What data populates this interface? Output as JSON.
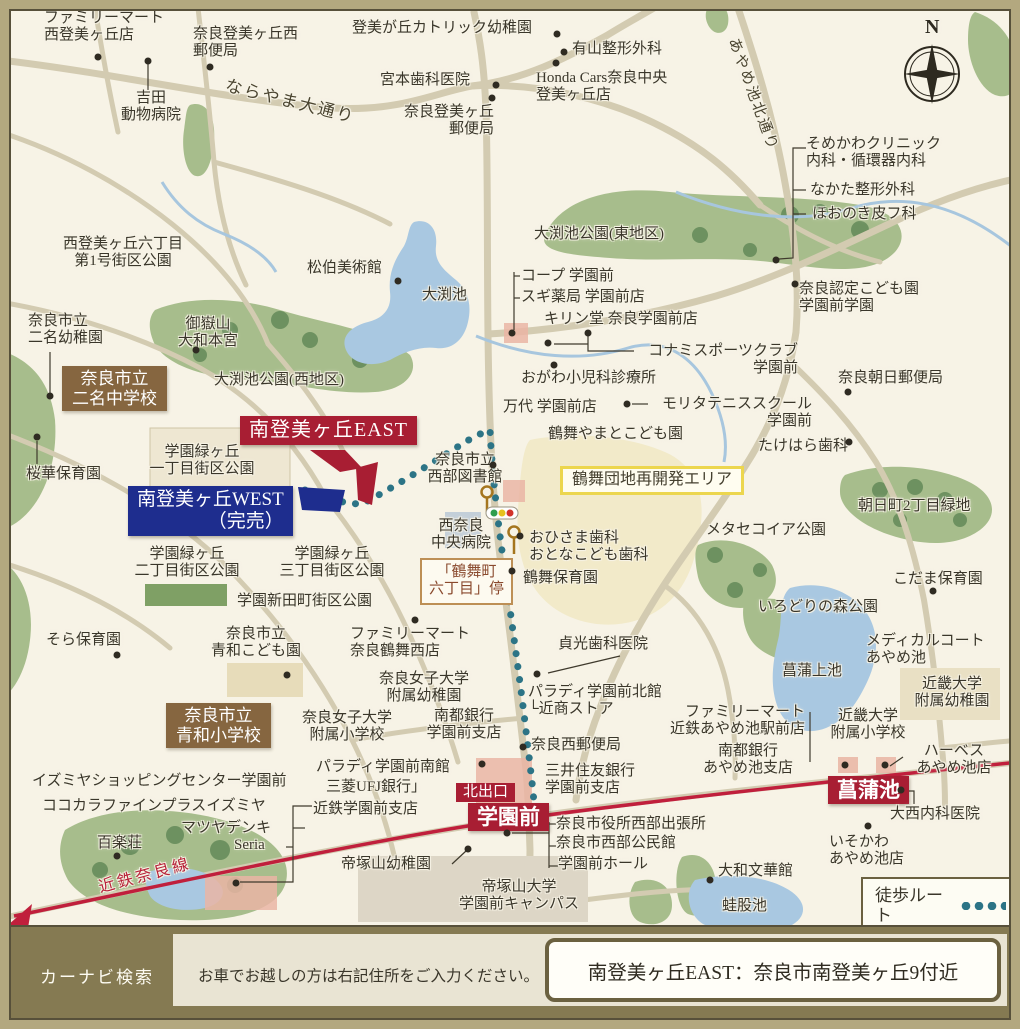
{
  "footer": {
    "navi_label": "カーナビ検索",
    "notice": "お車でお越しの方は右記住所をご入力ください。",
    "address": "南登美ヶ丘EAST：奈良市南登美ヶ丘9付近"
  },
  "colors": {
    "map_bg": "#f7f3e6",
    "road": "#d3cbb1",
    "park": "#a7bd8c",
    "tree": "#6d9160",
    "water": "#a9c8e1",
    "railway": "#c01f3c",
    "walk_route": "#2c7486",
    "badge_red": "#a81e33",
    "badge_blue": "#1e2d8e",
    "badge_brown": "#866640",
    "yellow_box_border": "#ecd64e",
    "frame": "#b3a87f",
    "footer_olive": "#857a52"
  },
  "map": {
    "labels": [
      {
        "name": "label-familymart-nishitomigaoka",
        "text": "ファミリーマート\n西登美ヶ丘店",
        "x": 44,
        "y": 10
      },
      {
        "name": "label-nara-tomigaoka-nishi-post",
        "text": "奈良登美ヶ丘西\n郵便局",
        "x": 193,
        "y": 26
      },
      {
        "name": "label-yoshida-animal-hospital",
        "text": "吉田\n動物病院",
        "x": 110,
        "y": 90,
        "w": 82,
        "align": "center"
      },
      {
        "name": "label-naráyama-odori-road",
        "text": "ならやま大通り",
        "x": 228,
        "y": 76,
        "type": "road",
        "rotate": 14
      },
      {
        "name": "label-tomigaoka-catholic-kindergarten",
        "text": "登美が丘カトリック幼稚園",
        "x": 352,
        "y": 20
      },
      {
        "name": "label-ariyama-seikei",
        "text": "有山整形外科",
        "x": 572,
        "y": 41
      },
      {
        "name": "label-miyamoto-dental",
        "text": "宮本歯科医院",
        "x": 380,
        "y": 72
      },
      {
        "name": "label-honda-cars",
        "text": "Honda Cars奈良中央\n登美ヶ丘店",
        "x": 536,
        "y": 70
      },
      {
        "name": "label-nara-tomigaoka-post",
        "text": "奈良登美ヶ丘\n郵便局",
        "x": 390,
        "y": 104,
        "w": 104,
        "align": "right"
      },
      {
        "name": "label-ayameike-kita-dori-road",
        "text": "あやめ池北通り",
        "x": 740,
        "y": 36,
        "type": "road",
        "rotate": 70,
        "size": 15
      },
      {
        "name": "label-compass-n",
        "text": "N",
        "x": 925,
        "y": 16,
        "type": "compass-n"
      },
      {
        "name": "label-somekawa-clinic",
        "text": "そめかわクリニック\n内科・循環器内科",
        "x": 806,
        "y": 136
      },
      {
        "name": "label-nakata-seikei",
        "text": "なかた整形外科",
        "x": 810,
        "y": 182
      },
      {
        "name": "label-hoonoki-hifuka",
        "text": "ほおのき皮フ科",
        "x": 812,
        "y": 206
      },
      {
        "name": "label-nishitomigaoka-6-park",
        "text": "西登美ヶ丘六丁目\n第1号街区公園",
        "x": 52,
        "y": 236,
        "w": 142,
        "align": "center"
      },
      {
        "name": "label-shohaku-museum",
        "text": "松伯美術館",
        "x": 307,
        "y": 260
      },
      {
        "name": "label-obuchi-pond",
        "text": "大渕池",
        "x": 422,
        "y": 287
      },
      {
        "name": "label-obuchi-park-east",
        "text": "大渕池公園(東地区)",
        "x": 534,
        "y": 226
      },
      {
        "name": "label-coop-gakuenmae",
        "text": "コープ 学園前",
        "x": 521,
        "y": 268
      },
      {
        "name": "label-sugi-pharmacy",
        "text": "スギ薬局 学園前店",
        "x": 521,
        "y": 289
      },
      {
        "name": "label-kirindo",
        "text": "キリン堂 奈良学園前店",
        "x": 544,
        "y": 311
      },
      {
        "name": "label-nara-nintei-kodomoen",
        "text": "奈良認定こども園\n学園前学園",
        "x": 799,
        "y": 281
      },
      {
        "name": "label-nimyo-kindergarten",
        "text": "奈良市立\n二名幼稚園",
        "x": 28,
        "y": 313
      },
      {
        "name": "label-mitakesan-yamato-hongu",
        "text": "御嶽山\n大和本宮",
        "x": 166,
        "y": 316,
        "w": 84,
        "align": "center"
      },
      {
        "name": "badge-nimyo-junior-high",
        "text": "奈良市立\n二名中学校",
        "x": 62,
        "y": 366,
        "type": "badge-brown"
      },
      {
        "name": "label-obuchi-park-west",
        "text": "大渕池公園(西地区)",
        "x": 214,
        "y": 372
      },
      {
        "name": "label-konami-sports",
        "text": "コナミスポーツクラブ\n学園前",
        "x": 634,
        "y": 343,
        "w": 164,
        "align": "right"
      },
      {
        "name": "label-ogawa-pediatrics",
        "text": "おがわ小児科診療所",
        "x": 521,
        "y": 370
      },
      {
        "name": "label-nara-asahi-post",
        "text": "奈良朝日郵便局",
        "x": 838,
        "y": 370
      },
      {
        "name": "label-mandai",
        "text": "万代 学園前店",
        "x": 503,
        "y": 399
      },
      {
        "name": "label-morita-tennis",
        "text": "モリタテニススクール\n学園前",
        "x": 640,
        "y": 396,
        "w": 172,
        "align": "right"
      },
      {
        "name": "badge-minamitomigaoka-east",
        "text": "南登美ヶ丘EAST",
        "x": 240,
        "y": 416,
        "type": "badge-red"
      },
      {
        "name": "label-tsurumai-yamato-kodomoen",
        "text": "鶴舞やまとこども園",
        "x": 548,
        "y": 426
      },
      {
        "name": "label-gakuen-midorigaoka-1-park",
        "text": "学園緑ヶ丘\n一丁目街区公園",
        "x": 140,
        "y": 444,
        "w": 124,
        "align": "center"
      },
      {
        "name": "label-seibu-library",
        "text": "奈良市立\n西部図書館",
        "x": 412,
        "y": 452,
        "w": 106,
        "align": "center"
      },
      {
        "name": "label-takehara-dental",
        "text": "たけはら歯科",
        "x": 758,
        "y": 438
      },
      {
        "name": "box-tsurumai-redevelopment",
        "text": "鶴舞団地再開発エリア",
        "x": 560,
        "y": 466,
        "type": "box-yellow"
      },
      {
        "name": "label-ouka-hoikuen",
        "text": "桜華保育園",
        "x": 26,
        "y": 466
      },
      {
        "name": "badge-minamitomigaoka-west",
        "text": "南登美ヶ丘WEST\n（完売）",
        "x": 128,
        "y": 486,
        "type": "badge-blue",
        "align": "right"
      },
      {
        "name": "label-asahicho-2-ryokuchi",
        "text": "朝日町2丁目緑地",
        "x": 858,
        "y": 498
      },
      {
        "name": "label-nishinara-chuo-hospital",
        "text": "西奈良\n中央病院",
        "x": 422,
        "y": 518,
        "w": 78,
        "align": "center"
      },
      {
        "name": "label-ohisama-dental",
        "text": "おひさま歯科\nおとなこども歯科",
        "x": 529,
        "y": 530
      },
      {
        "name": "label-metasequoia-park",
        "text": "メタセコイア公園",
        "x": 706,
        "y": 522
      },
      {
        "name": "label-gakuen-midorigaoka-2-park",
        "text": "学園緑ヶ丘\n二丁目街区公園",
        "x": 124,
        "y": 546,
        "w": 126,
        "align": "center"
      },
      {
        "name": "label-gakuen-midorigaoka-3-park",
        "text": "学園緑ヶ丘\n三丁目街区公園",
        "x": 268,
        "y": 546,
        "w": 128,
        "align": "center"
      },
      {
        "name": "box-tsurumaicho-6-busstop",
        "text": "「鶴舞町\n六丁目」停",
        "x": 420,
        "y": 558,
        "type": "box-busstop"
      },
      {
        "name": "label-tsurumai-hoikuen",
        "text": "鶴舞保育園",
        "x": 523,
        "y": 570
      },
      {
        "name": "label-kodama-hoikuen",
        "text": "こだま保育園",
        "x": 893,
        "y": 571
      },
      {
        "name": "label-gakuen-shindencho-park",
        "text": "学園新田町街区公園",
        "x": 237,
        "y": 593
      },
      {
        "name": "label-irodori-forest-park",
        "text": "いろどりの森公園",
        "x": 758,
        "y": 599
      },
      {
        "name": "label-shobu-kami-pond",
        "text": "菖蒲上池",
        "x": 782,
        "y": 663
      },
      {
        "name": "label-medical-court-ayameike",
        "text": "メディカルコート\nあやめ池",
        "x": 866,
        "y": 633
      },
      {
        "name": "label-sora-hoikuen",
        "text": "そら保育園",
        "x": 46,
        "y": 632
      },
      {
        "name": "label-seiwa-kodomoen",
        "text": "奈良市立\n青和こども園",
        "x": 200,
        "y": 626,
        "w": 112,
        "align": "center"
      },
      {
        "name": "label-familymart-tsurumai-nishi",
        "text": "ファミリーマート\n奈良鶴舞西店",
        "x": 350,
        "y": 626
      },
      {
        "name": "label-sadamitsu-dental",
        "text": "貞光歯科医院",
        "x": 558,
        "y": 636
      },
      {
        "name": "label-narajoshi-kindergarten",
        "text": "奈良女子大学\n附属幼稚園",
        "x": 368,
        "y": 671,
        "w": 112,
        "align": "center"
      },
      {
        "name": "label-paradis-kitakan",
        "text": "パラディ学園前北館\n└近商ストア",
        "x": 528,
        "y": 684
      },
      {
        "name": "label-kindai-kindergarten",
        "text": "近畿大学\n附属幼稚園",
        "x": 900,
        "y": 676,
        "w": 104,
        "align": "center"
      },
      {
        "name": "badge-seiwa-elementary",
        "text": "奈良市立\n青和小学校",
        "x": 166,
        "y": 703,
        "type": "badge-brown"
      },
      {
        "name": "label-narajoshi-elementary",
        "text": "奈良女子大学\n附属小学校",
        "x": 291,
        "y": 710,
        "w": 112,
        "align": "center"
      },
      {
        "name": "label-nanto-bank-gakuenmae",
        "text": "南都銀行\n学園前支店",
        "x": 420,
        "y": 708,
        "w": 88,
        "align": "center"
      },
      {
        "name": "label-familymart-ayameike",
        "text": "ファミリーマート\n近鉄あやめ池駅前店",
        "x": 653,
        "y": 704,
        "w": 152,
        "align": "right"
      },
      {
        "name": "label-kindai-elementary",
        "text": "近畿大学\n附属小学校",
        "x": 820,
        "y": 708,
        "w": 96,
        "align": "center"
      },
      {
        "name": "label-nara-nishi-post",
        "text": "奈良西郵便局",
        "x": 531,
        "y": 737
      },
      {
        "name": "label-nanto-bank-ayameike",
        "text": "南都銀行\nあやめ池支店",
        "x": 694,
        "y": 743,
        "w": 108,
        "align": "center"
      },
      {
        "name": "label-harves-ayameike",
        "text": "ハーベス\nあやめ池店",
        "x": 901,
        "y": 743,
        "w": 106,
        "align": "center"
      },
      {
        "name": "label-izumiya-sc",
        "text": "イズミヤショッピングセンター学園前",
        "x": 32,
        "y": 773
      },
      {
        "name": "label-cocokara-fine",
        "text": "ココカラファインプラスイズミヤ",
        "x": 42,
        "y": 798
      },
      {
        "name": "label-paradis-minamikan",
        "text": "パラディ学園前南館",
        "x": 316,
        "y": 759
      },
      {
        "name": "label-mufg-bank",
        "text": "三菱UFJ銀行」",
        "x": 326,
        "y": 779
      },
      {
        "name": "badge-kita-deguchi",
        "text": "北出口",
        "x": 456,
        "y": 783,
        "type": "exit"
      },
      {
        "name": "label-smbc",
        "text": "三井住友銀行\n学園前支店",
        "x": 545,
        "y": 763
      },
      {
        "name": "label-matsuya-denki",
        "text": "マツヤデンキ",
        "x": 181,
        "y": 820
      },
      {
        "name": "label-kintetsu-gakuenmae-branch",
        "text": "近鉄学園前支店",
        "x": 313,
        "y": 801
      },
      {
        "name": "station-gakuenmae",
        "text": "学園前",
        "x": 468,
        "y": 803,
        "type": "station"
      },
      {
        "name": "label-seria",
        "text": "Seria",
        "x": 234,
        "y": 837
      },
      {
        "name": "label-city-office-seibu",
        "text": "奈良市役所西部出張所",
        "x": 556,
        "y": 816
      },
      {
        "name": "label-seibu-kominkan",
        "text": "奈良市西部公民館",
        "x": 556,
        "y": 835
      },
      {
        "name": "label-hyakurakuso",
        "text": "百楽荘",
        "x": 97,
        "y": 835
      },
      {
        "name": "station-ayameike",
        "text": "菖蒲池",
        "x": 828,
        "y": 776,
        "type": "station"
      },
      {
        "name": "label-onishi-clinic",
        "text": "大西内科医院",
        "x": 890,
        "y": 806
      },
      {
        "name": "label-gakuenmae-hall",
        "text": "学園前ホール",
        "x": 558,
        "y": 856
      },
      {
        "name": "label-tezukayama-kindergarten",
        "text": "帝塚山幼稚園",
        "x": 341,
        "y": 856
      },
      {
        "name": "label-isokawa-ayameike",
        "text": "いそかわ\nあやめ池店",
        "x": 829,
        "y": 834
      },
      {
        "name": "label-yamato-bunkakan",
        "text": "大和文華館",
        "x": 718,
        "y": 863
      },
      {
        "name": "label-kintetsu-nara-line",
        "text": "近鉄奈良線",
        "x": 97,
        "y": 880,
        "type": "rail",
        "rotate": -15
      },
      {
        "name": "label-tezukayama-univ",
        "text": "帝塚山大学\n学園前キャンパス",
        "x": 446,
        "y": 879,
        "w": 146,
        "align": "center"
      },
      {
        "name": "label-kaerumata-pond",
        "text": "蛙股池",
        "x": 722,
        "y": 898
      },
      {
        "name": "legend-walk-route",
        "text": "徒歩ルート",
        "x": 861,
        "y": 877,
        "type": "legend"
      }
    ],
    "dots": [
      [
        98,
        57
      ],
      [
        210,
        67
      ],
      [
        148,
        61
      ],
      [
        557,
        34
      ],
      [
        564,
        52
      ],
      [
        496,
        85
      ],
      [
        492,
        98
      ],
      [
        556,
        63
      ],
      [
        398,
        281
      ],
      [
        795,
        284
      ],
      [
        776,
        260
      ],
      [
        196,
        350
      ],
      [
        50,
        396
      ],
      [
        37,
        437
      ],
      [
        512,
        333
      ],
      [
        588,
        333
      ],
      [
        548,
        343
      ],
      [
        554,
        365
      ],
      [
        627,
        404
      ],
      [
        848,
        392
      ],
      [
        493,
        465
      ],
      [
        849,
        442
      ],
      [
        520,
        536
      ],
      [
        512,
        571
      ],
      [
        933,
        591
      ],
      [
        117,
        655
      ],
      [
        287,
        675
      ],
      [
        415,
        620
      ],
      [
        537,
        674
      ],
      [
        523,
        747
      ],
      [
        482,
        764
      ],
      [
        507,
        833
      ],
      [
        468,
        849
      ],
      [
        901,
        790
      ],
      [
        868,
        826
      ],
      [
        710,
        880
      ],
      [
        117,
        856
      ],
      [
        845,
        765
      ],
      [
        885,
        765
      ],
      [
        236,
        883
      ]
    ]
  }
}
